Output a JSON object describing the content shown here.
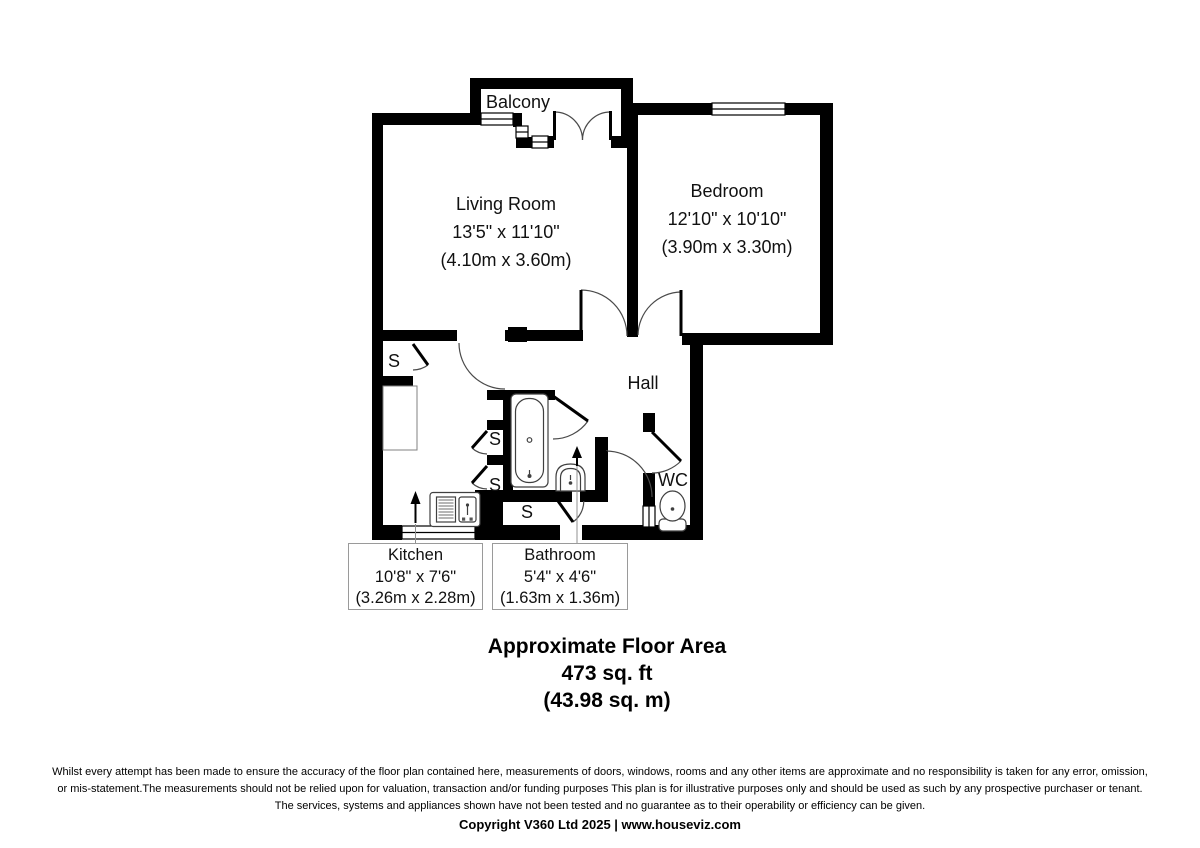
{
  "colors": {
    "background": "#ffffff",
    "wall": "#000000",
    "fixture_line": "#3f3f3f",
    "door_arc": "#4a4a4a",
    "callout_border": "#9a9a9a"
  },
  "rooms": {
    "living_room": {
      "name": "Living Room",
      "imperial": "13'5\" x 11'10\"",
      "metric": "(4.10m x 3.60m)"
    },
    "bedroom": {
      "name": "Bedroom",
      "imperial": "12'10\" x 10'10\"",
      "metric": "(3.90m x 3.30m)"
    },
    "balcony": {
      "name": "Balcony"
    },
    "hall": {
      "name": "Hall"
    },
    "wc": {
      "name": "WC"
    },
    "storage": {
      "label": "S"
    }
  },
  "callouts": {
    "kitchen": {
      "name": "Kitchen",
      "imperial": "10'8\" x 7'6\"",
      "metric": "(3.26m x 2.28m)"
    },
    "bathroom": {
      "name": "Bathroom",
      "imperial": "5'4\" x 4'6\"",
      "metric": "(1.63m x 1.36m)"
    }
  },
  "area_summary": {
    "title": "Approximate Floor Area",
    "imperial": "473 sq. ft",
    "metric": "(43.98 sq. m)"
  },
  "footer": {
    "disclaimer_lines": [
      "Whilst every attempt has been made to ensure the accuracy of the floor plan contained here, measurements of doors, windows, rooms and any other items are approximate and no responsibility is taken for any error, omission,",
      "or mis-statement.The measurements should not be relied upon for valuation, transaction and/or funding purposes This plan is for illustrative purposes only and should be used as such by any prospective purchaser or tenant.",
      "The services, systems and appliances shown have not been tested and no guarantee as to their operability or efficiency can be given."
    ],
    "copyright": "Copyright V360 Ltd 2025 | www.houseviz.com"
  }
}
